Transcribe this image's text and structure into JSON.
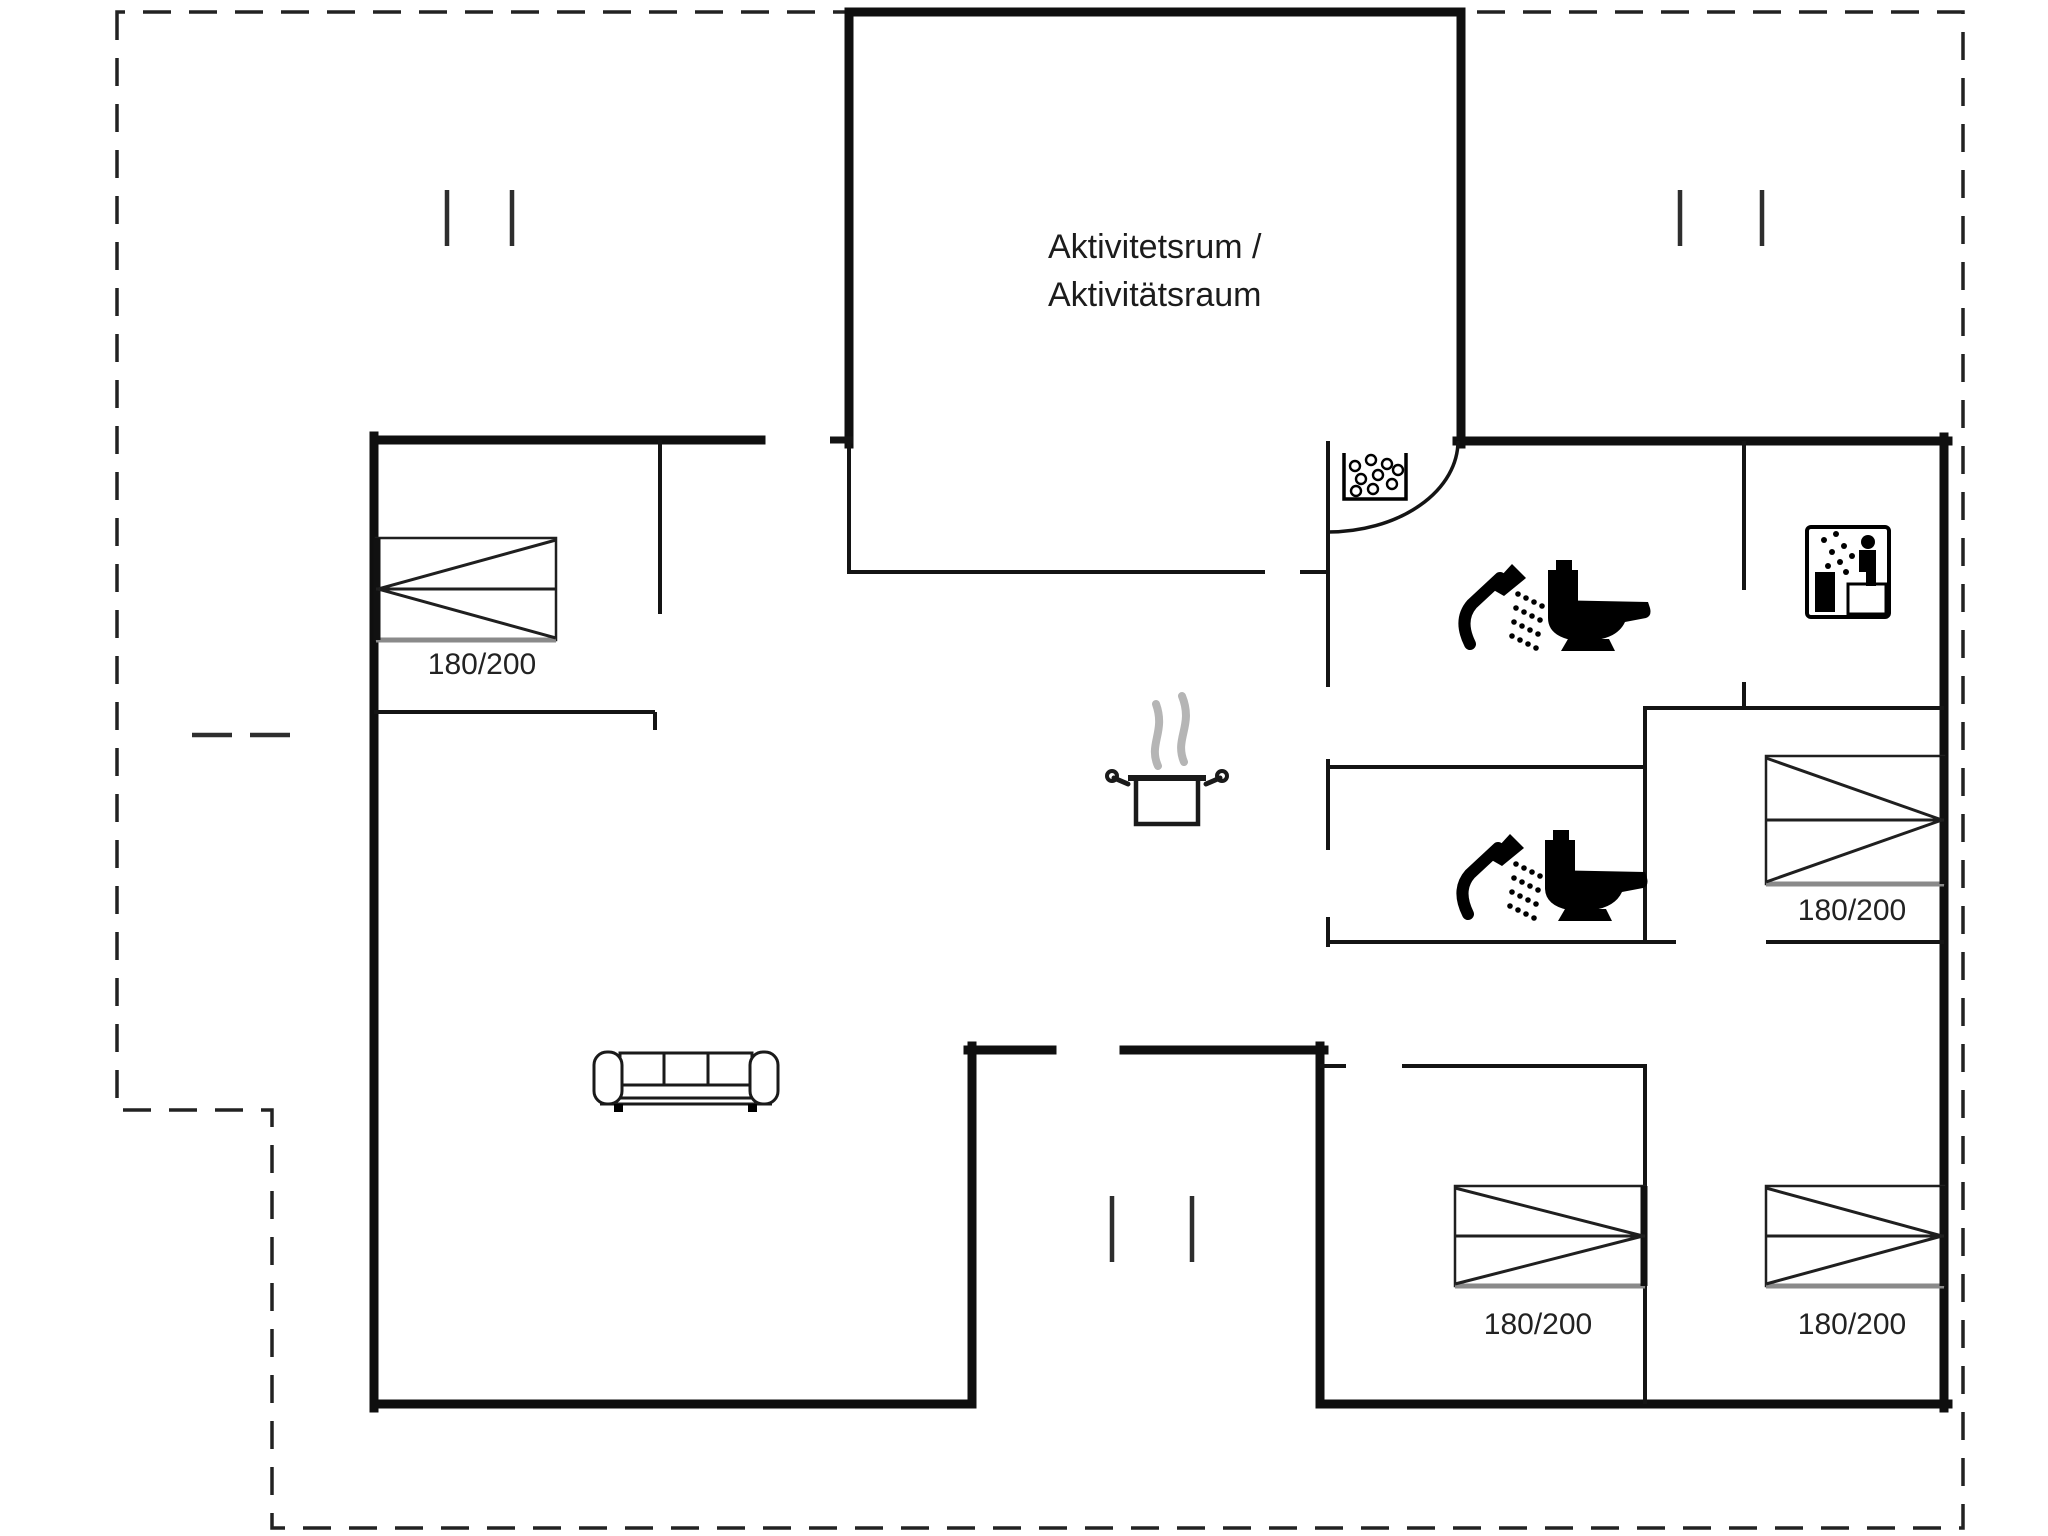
{
  "document": {
    "type": "floor-plan",
    "background": "#ffffff"
  },
  "colors": {
    "wall": "#0f0f0f",
    "interior_wall": "#141414",
    "boundary_dash": "#222222",
    "gray_accent": "#8a8a8a",
    "steam": "#b5b5b5",
    "text": "#1c1c1c"
  },
  "activity_room": {
    "label_line1": "Aktivitetsrum /",
    "label_line2": "Aktivitätsraum"
  },
  "beds": [
    {
      "id": "bed-top-left",
      "size": "180/200"
    },
    {
      "id": "bed-middle-right",
      "size": "180/200"
    },
    {
      "id": "bed-bottom-center",
      "size": "180/200"
    },
    {
      "id": "bed-bottom-right",
      "size": "180/200"
    }
  ],
  "icons": {
    "shower": "shower-icon",
    "toilet": "toilet-icon",
    "sauna": "sauna-icon",
    "whirlpool": "whirlpool-icon",
    "cooking_pot": "cooking-pot-icon",
    "sofa": "sofa-icon"
  }
}
